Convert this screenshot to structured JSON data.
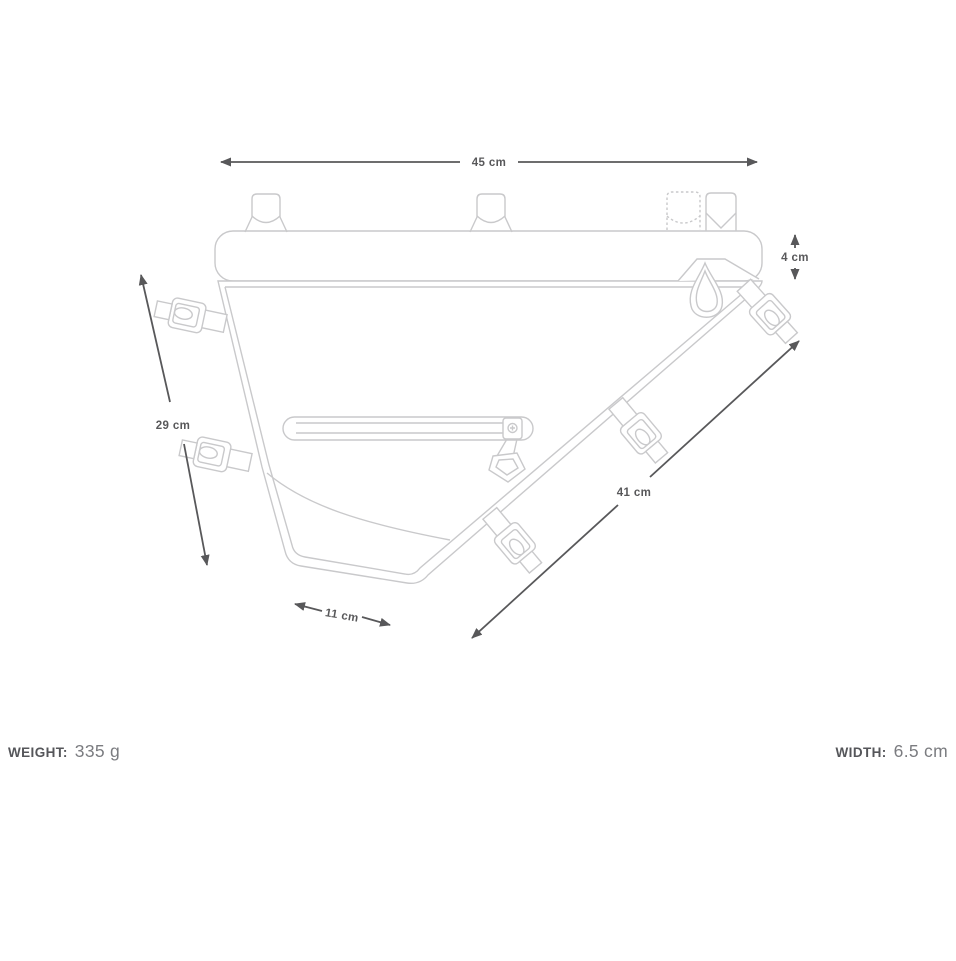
{
  "product_diagram": {
    "title": "frame-bag-dimension-diagram",
    "dimensions": {
      "top_width": "45 cm",
      "tube_height": "4 cm",
      "left_height": "29 cm",
      "diagonal_length": "41 cm",
      "bottom_width": "11 cm"
    },
    "specs": {
      "weight_label": "WEIGHT:",
      "weight_value": "335 g",
      "width_label": "WIDTH:",
      "width_value": "6.5 cm"
    }
  },
  "colors": {
    "artwork_line": "#c9c9cb",
    "dimension_line": "#58585a",
    "spec_value_text": "#7b7c80"
  }
}
